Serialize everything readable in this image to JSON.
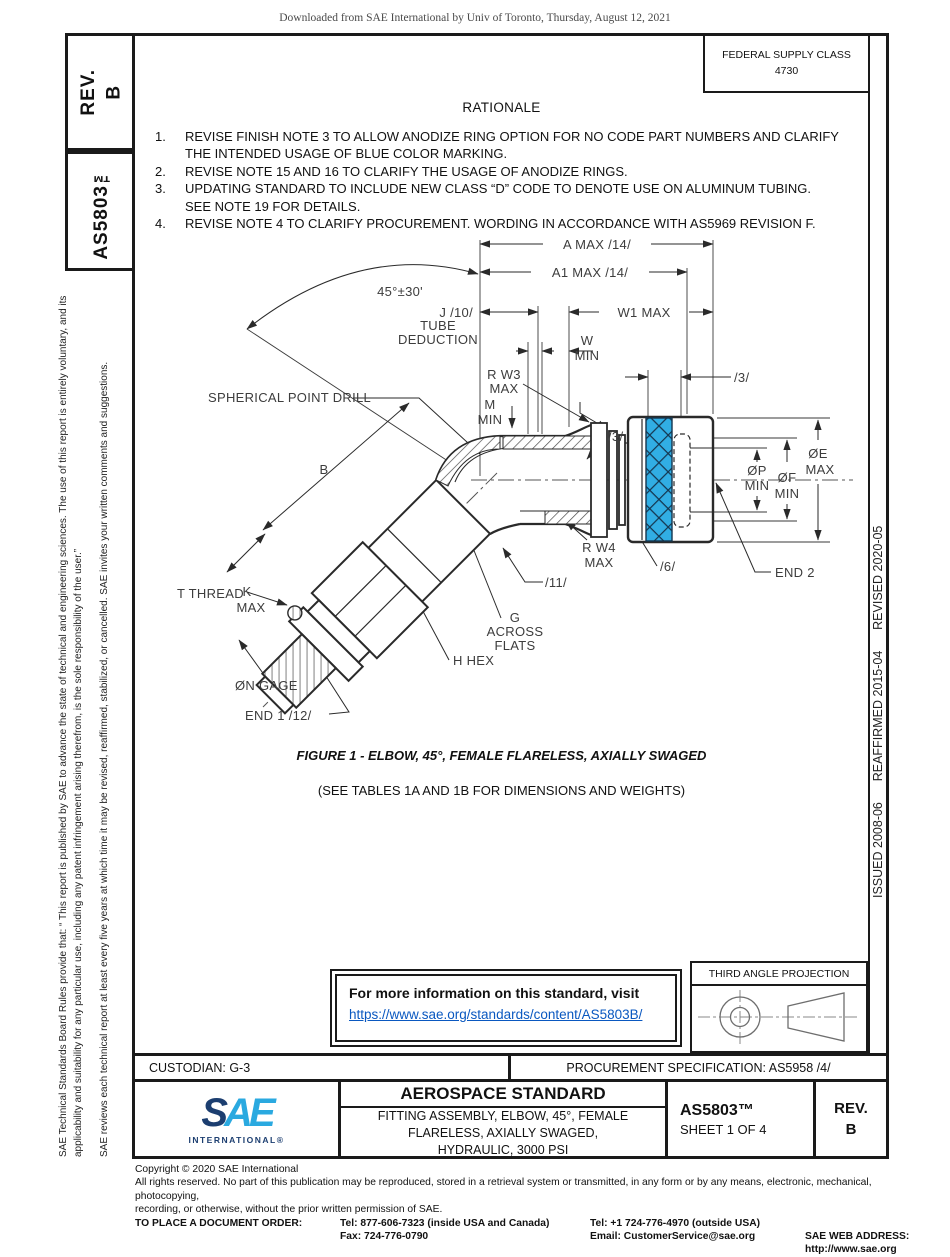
{
  "watermark": "Downloaded from SAE International by Univ of Toronto, Thursday, August 12, 2021",
  "sidebar": {
    "rev_label": "REV.",
    "rev_value": "B",
    "doc_number": "AS5803™",
    "legal_p1": "SAE Technical Standards Board Rules provide that: “ This report is published by SAE to advance the state of technical and engineering sciences. The use of this report is entirely voluntary, and its applicability and suitability for any particular use, including any patent infringement arising therefrom, is the sole responsibility of the user.”",
    "legal_p2": "SAE reviews each technical report at least every five years at which time it may be revised, reaffirmed, stabilized, or cancelled. SAE invites your written comments and suggestions."
  },
  "revision_strip": "ISSUED 2008-06      REAFFIRMED 2015-04      REVISED 2020-05",
  "header": {
    "fsc_line1": "FEDERAL SUPPLY CLASS",
    "fsc_line2": "4730",
    "rationale_title": "RATIONALE"
  },
  "rationale_items": [
    {
      "num": "1.",
      "text": "REVISE FINISH NOTE 3 TO ALLOW ANODIZE RING OPTION FOR NO CODE PART NUMBERS AND CLARIFY THE INTENDED USAGE OF BLUE COLOR MARKING."
    },
    {
      "num": "2.",
      "text": "REVISE NOTE 15 AND 16 TO CLARIFY THE USAGE OF ANODIZE RINGS."
    },
    {
      "num": "3.",
      "text": "UPDATING STANDARD TO INCLUDE NEW CLASS “D” CODE TO DENOTE USE ON ALUMINUM TUBING.\nSEE NOTE 19 FOR DETAILS."
    },
    {
      "num": "4.",
      "text": "REVISE NOTE 4 TO CLARIFY PROCUREMENT. WORDING IN ACCORDANCE WITH AS5969 REVISION F."
    }
  ],
  "drawing": {
    "labels": {
      "a": "A MAX /14/",
      "a1": "A1 MAX /14/",
      "angle": "45°±30'",
      "j": "J /10/",
      "tube": "TUBE",
      "deduction": "DEDUCTION",
      "w1": "W1 MAX",
      "w": "W",
      "w_min": "MIN",
      "rw3": "R W3",
      "rw3_max": "MAX",
      "w2": "ØW2",
      "m": "M",
      "m_min": "MIN",
      "flag3_top": "/3/",
      "flag3_mid": "/3/",
      "spherical": "SPHERICAL POINT DRILL",
      "b": "B",
      "k": "K",
      "k_max": "MAX",
      "t_thread": "T THREAD",
      "rw4": "R W4",
      "rw4_max": "MAX",
      "flag11": "/11/",
      "flag6": "/6/",
      "end2": "END 2",
      "e": "ØE",
      "e_max": "MAX",
      "p": "ØP",
      "p_min": "MIN",
      "f": "ØF",
      "f_min": "MIN",
      "g": "G",
      "g_across": "ACROSS",
      "g_flats": "FLATS",
      "h_hex": "H HEX",
      "n_gage": "ØN GAGE",
      "end1": "END 1 /12/"
    }
  },
  "figure": {
    "caption": "FIGURE 1 - ELBOW, 45°, FEMALE FLARELESS, AXIALLY SWAGED",
    "note": "(SEE TABLES 1A AND 1B FOR DIMENSIONS AND WEIGHTS)"
  },
  "info_box": {
    "line1": "For more information on this standard, visit",
    "link": "https://www.sae.org/standards/content/AS5803B/"
  },
  "projection": {
    "title": "THIRD ANGLE PROJECTION"
  },
  "footer_bar": {
    "custodian": "CUSTODIAN: G-3",
    "procurement": "PROCUREMENT SPECIFICATION: AS5958 /4/"
  },
  "title_block": {
    "logo_s": "S",
    "logo_a": "A",
    "logo_e": "E",
    "logo_sub": "INTERNATIONAL®",
    "heading": "AEROSPACE STANDARD",
    "title_line1": "FITTING ASSEMBLY, ELBOW, 45°, FEMALE",
    "title_line2": "FLARELESS, AXIALLY SWAGED,",
    "title_line3": "HYDRAULIC, 3000 PSI",
    "doc_number": "AS5803™",
    "sheet": "SHEET 1 OF 4",
    "rev_label": "REV.",
    "rev_value": "B"
  },
  "legal_footer": {
    "copyright": "Copyright © 2020 SAE International",
    "rights_1": "All rights reserved. No part of this publication may be reproduced, stored in a retrieval system or transmitted, in any form or by any means, electronic, mechanical, photocopying,",
    "rights_2": "recording, or otherwise, without the prior written permission of SAE.",
    "order_label": "TO PLACE A DOCUMENT ORDER:",
    "tel_inside": "Tel: 877-606-7323 (inside USA and Canada)",
    "tel_outside": "Tel: +1 724-776-4970 (outside USA)",
    "fax": "Fax: 724-776-0790",
    "email": "Email: CustomerService@sae.org",
    "web": "SAE WEB ADDRESS: http://www.sae.org"
  },
  "colors": {
    "swage_band_blue": "#31aee4",
    "link_blue": "#0a58c0",
    "sae_navy": "#1c3e70",
    "sae_cyan": "#2aa9e0"
  }
}
